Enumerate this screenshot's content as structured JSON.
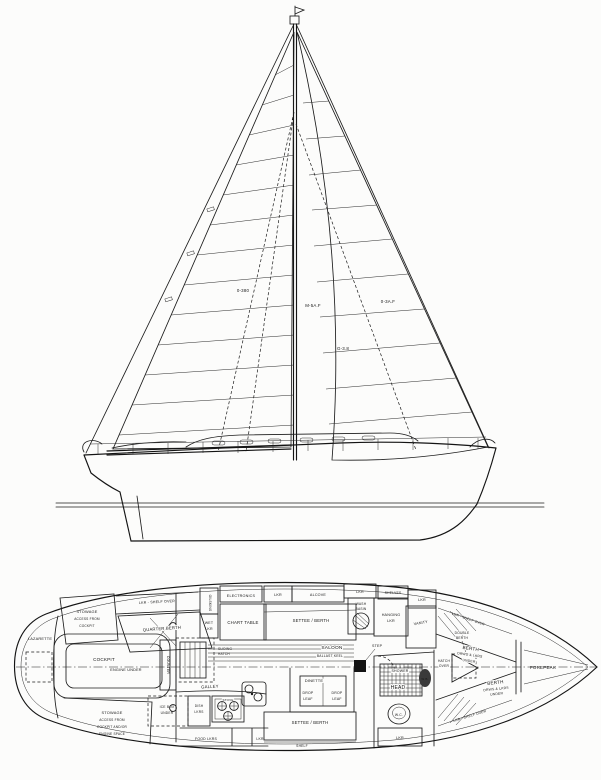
{
  "drawing": {
    "ink": "#1c1c1c",
    "profile": {
      "sail_annotations": [
        "0-380",
        "M-5A.F",
        "0-3A.F",
        "G-3.8"
      ]
    },
    "plan": {
      "aft": {
        "lazarette": "LAZARETTE",
        "stowage_stbd": [
          "STOWAGE",
          "ACCESS FROM",
          "COCKPIT"
        ],
        "stowage_port": [
          "STOWAGE",
          "ACCESS FROM",
          "COCKPIT AND/OR",
          "ENGINE SPACE"
        ],
        "cockpit": "COCKPIT",
        "engine_under": "ENGINE UNDER",
        "lkr_shelf_over": "LKR - SHELF OVER",
        "quarter_berth": "QUARTER BERTH",
        "counter": "COUNTER",
        "sliding_hatch": [
          "SLIDING",
          "HATCH"
        ]
      },
      "nav": {
        "oilskins": "OILSKINS",
        "wet_lkr": [
          "WET",
          "LKR"
        ],
        "electronics": "ELECTRONICS",
        "chart_table": "CHART TABLE"
      },
      "saloon": {
        "label": "SALOON",
        "ballast": "BALLAST KEEL",
        "step": "STEP",
        "dinette": "DINETTE",
        "drop_leaf": [
          "DROP",
          "LEAF"
        ],
        "settee_berth_stbd": "SETTEE / BERTH",
        "settee_berth_port": "SETTEE / BERTH",
        "shelf": "SHELF",
        "lkr1": "LKR",
        "alcove": "ALCOVE",
        "lkr2": "LKR",
        "shelves": "SHELVES",
        "lkr3": "LKR"
      },
      "galley": {
        "label": "GALLEY",
        "stove": "STOVE",
        "ice_box": [
          "ICE BOX",
          "UNDER"
        ],
        "dish_lkrs": [
          "DISH",
          "LKRS"
        ],
        "food_lkrs": "FOOD LKRS",
        "lkr": "LKR"
      },
      "head": {
        "shower": "SHOWER",
        "label": "HEAD",
        "wc": "W.C.",
        "wb": "W.B.",
        "lkr": "LKR",
        "wash_basin": [
          "WASH",
          "BASIN"
        ],
        "hanging_lkr": [
          "HANGING",
          "LKR"
        ],
        "vanity": "VANITY"
      },
      "fwd": {
        "berth_stbd": [
          "BERTH",
          "DRWS & LKRS",
          "UNDER"
        ],
        "berth_port": [
          "BERTH",
          "DRWS & LKRS",
          "UNDER"
        ],
        "double_berth": [
          "DOUBLE",
          "BERTH"
        ],
        "hatch_over": [
          "HATCH",
          "OVER"
        ],
        "forepeak": "FOREPEAK",
        "lkr": "LKR",
        "shelf_top": "LKR - SHELF OVER",
        "shelf_bottom": "LKR - SHELF OVER"
      }
    }
  }
}
